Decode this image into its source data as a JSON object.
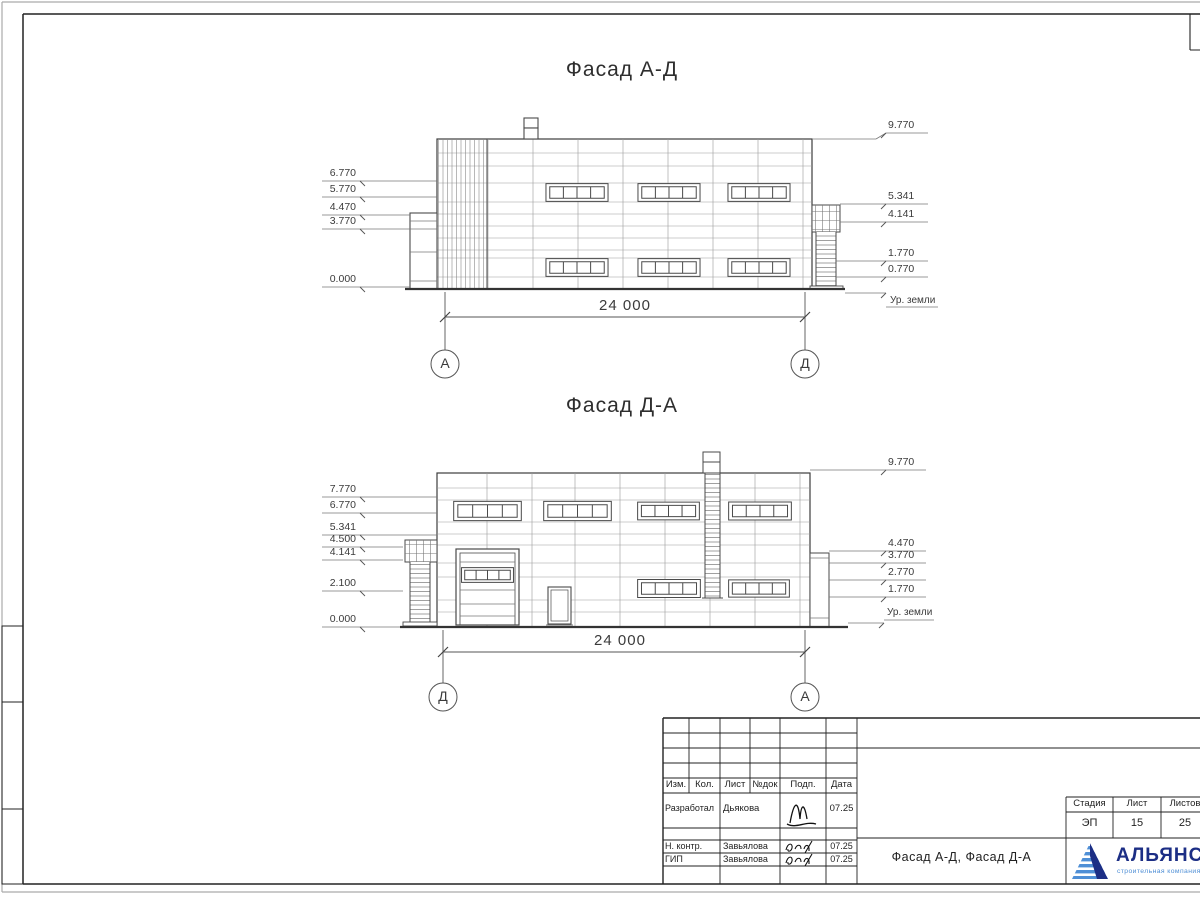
{
  "facade1": {
    "title": "Фасад А-Д",
    "dimension": "24 000",
    "axis_left": "А",
    "axis_right": "Д",
    "left_marks": [
      "6.770",
      "5.770",
      "4.470",
      "3.770",
      "0.000"
    ],
    "right_marks": [
      "9.770",
      "5.341",
      "4.141",
      "1.770",
      "0.770"
    ],
    "ground": "Ур. земли"
  },
  "facade2": {
    "title": "Фасад Д-А",
    "dimension": "24 000",
    "axis_left": "Д",
    "axis_right": "А",
    "left_marks": [
      "7.770",
      "6.770",
      "5.341",
      "4.500",
      "4.141",
      "2.100",
      "0.000"
    ],
    "right_marks": [
      "9.770",
      "4.470",
      "3.770",
      "2.770",
      "1.770"
    ],
    "ground": "Ур. земли"
  },
  "title_block": {
    "columns": [
      "Изм.",
      "Кол.",
      "Лист",
      "№док",
      "Подп.",
      "Дата"
    ],
    "rows": [
      {
        "role": "Разработал",
        "name": "Дьякова",
        "date": "07.25"
      },
      {
        "role": "Н. контр.",
        "name": "Завьялова",
        "date": "07.25"
      },
      {
        "role": "ГИП",
        "name": "Завьялова",
        "date": "07.25"
      }
    ],
    "doc_title": "Фасад А-Д, Фасад Д-А",
    "stage_columns": [
      "Стадия",
      "Лист",
      "Листов"
    ],
    "stage": "ЭП",
    "sheet": "15",
    "sheets_total": "25",
    "logo": {
      "name": "АЛЬЯНС",
      "subtitle": "строительная компания"
    },
    "accent_navy": "#1c2e85",
    "accent_blue": "#4f8fd6"
  }
}
